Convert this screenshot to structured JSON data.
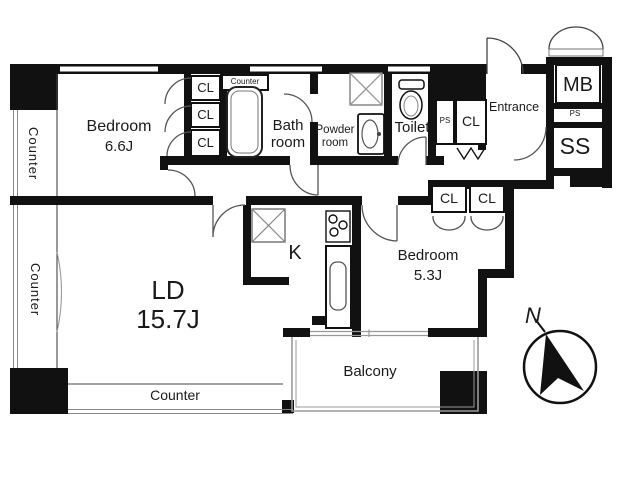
{
  "floorplan": {
    "bedroom1": {
      "name": "Bedroom",
      "area": "6.6J"
    },
    "bedroom2": {
      "name": "Bedroom",
      "area": "5.3J"
    },
    "living_dining": {
      "name": "LD",
      "area": "15.7J"
    },
    "kitchen": {
      "name": "K"
    },
    "bathroom": {
      "line1": "Bath",
      "line2": "room"
    },
    "powder_room": {
      "line1": "Powder",
      "line2": "room"
    },
    "toilet": {
      "name": "Toilet"
    },
    "entrance": {
      "name": "Entrance"
    },
    "balcony": {
      "name": "Balcony"
    },
    "meter_box": {
      "name": "MB"
    },
    "storage": {
      "name": "SS"
    },
    "pipe_space": {
      "name": "PS"
    },
    "closet": {
      "name": "CL"
    },
    "counter": {
      "name": "Counter"
    },
    "compass": {
      "north": "N"
    }
  },
  "colors": {
    "wall": "#111111",
    "door_line": "#555555",
    "window_line": "#888888",
    "background": "#ffffff",
    "text": "#1a1a1a"
  }
}
